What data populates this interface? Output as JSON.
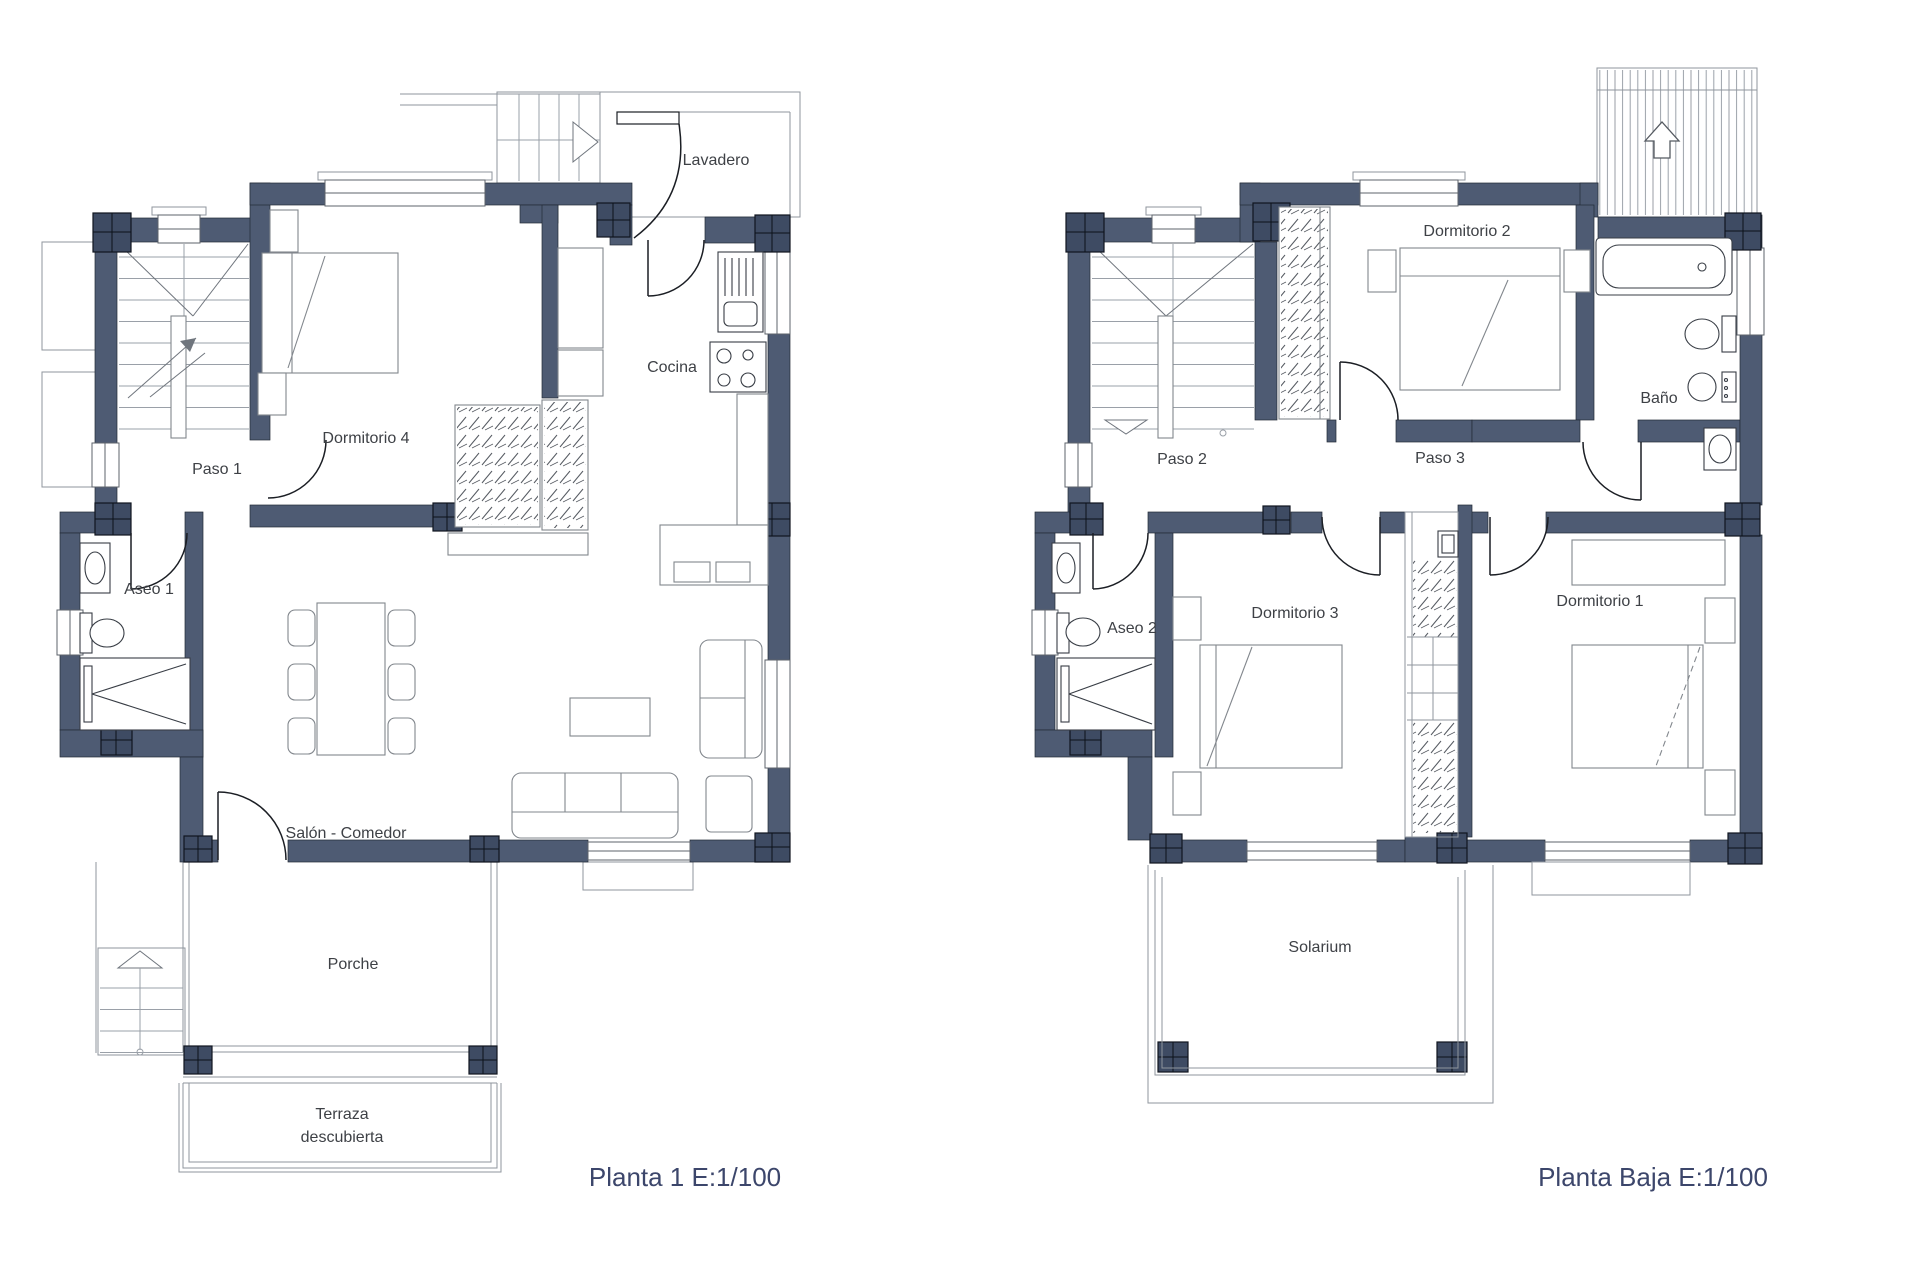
{
  "plans": {
    "planta1": {
      "caption": "Planta 1 E:1/100",
      "rooms": {
        "lavadero": "Lavadero",
        "cocina": "Cocina",
        "dormitorio4": "Dormitorio 4",
        "paso1": "Paso 1",
        "aseo1": "Aseo 1",
        "salon_comedor": "Salón - Comedor",
        "porche": "Porche",
        "terraza_l1": "Terraza",
        "terraza_l2": "descubierta"
      }
    },
    "planta_baja": {
      "caption": "Planta Baja E:1/100",
      "rooms": {
        "dormitorio2": "Dormitorio 2",
        "bano": "Baño",
        "paso2": "Paso 2",
        "paso3": "Paso 3",
        "aseo2": "Aseo 2",
        "dormitorio3": "Dormitorio 3",
        "dormitorio1": "Dormitorio 1",
        "solarium": "Solarium"
      }
    },
    "colors": {
      "wall": "#4e5b73",
      "column": "#3e4b63",
      "caption_text": "#3c466b",
      "label_text": "#3e4146"
    }
  }
}
